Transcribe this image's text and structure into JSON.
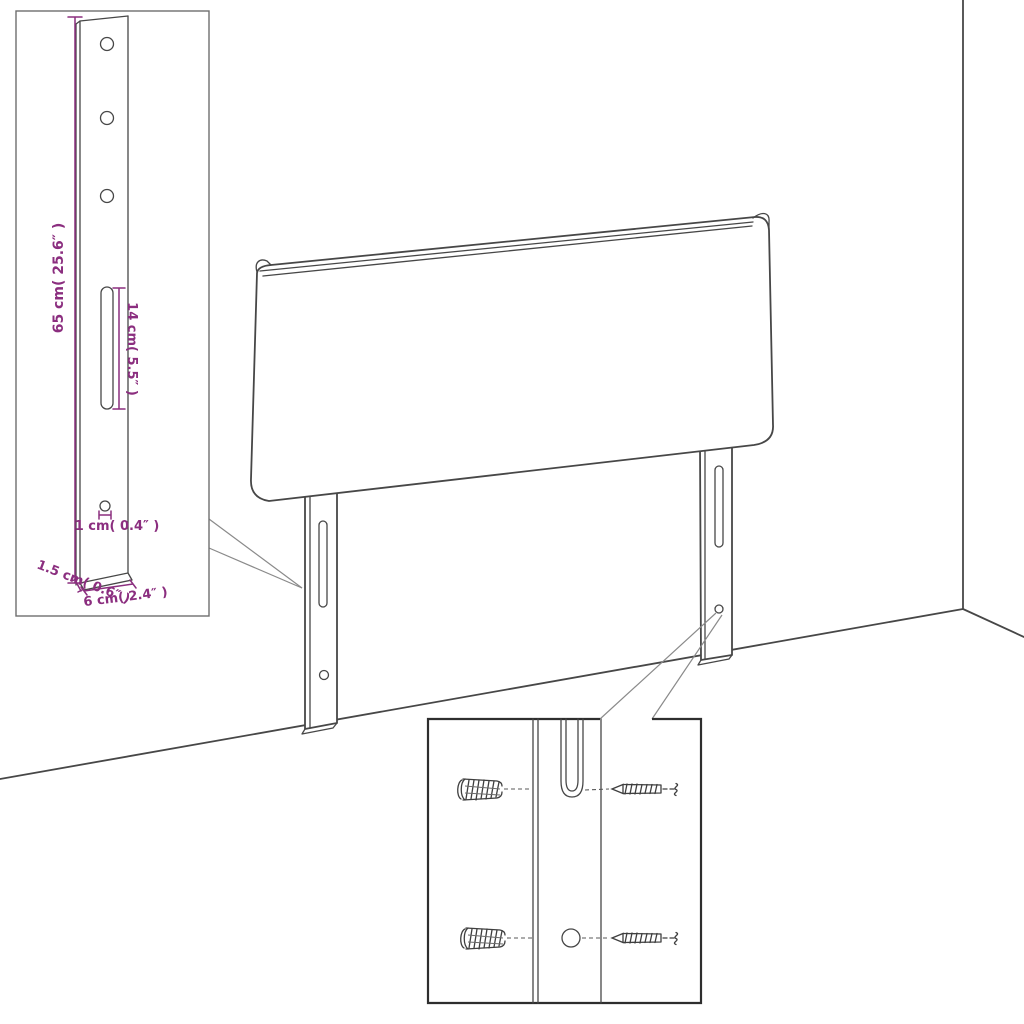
{
  "diagram_title": "headboard-assembly-dimension-diagram",
  "colors": {
    "line": "#474747",
    "dimension": "#8b2e7f",
    "background": "#ffffff",
    "callout": "#8a8a8a",
    "inset_border_light": "#6e6e6e",
    "inset_border_dark": "#2e2e2e"
  },
  "headboard": {
    "legs": 2,
    "slots_per_leg": 1,
    "holes_per_leg": 1
  },
  "leg_detail": {
    "holes_top": 3,
    "slot": 1,
    "hole_bottom": 1,
    "dimensions": {
      "height": "65 cm( 25.6″ )",
      "slot_length": "14 cm( 5.5″ )",
      "hole": "1 cm( 0.4″ )",
      "depth": "1.5 cm( 0.6″ )",
      "width": "6 cm( 2.4″ )"
    }
  },
  "mounting_detail": {
    "rows": 2,
    "hardware": [
      "wall-plug",
      "screw"
    ]
  }
}
